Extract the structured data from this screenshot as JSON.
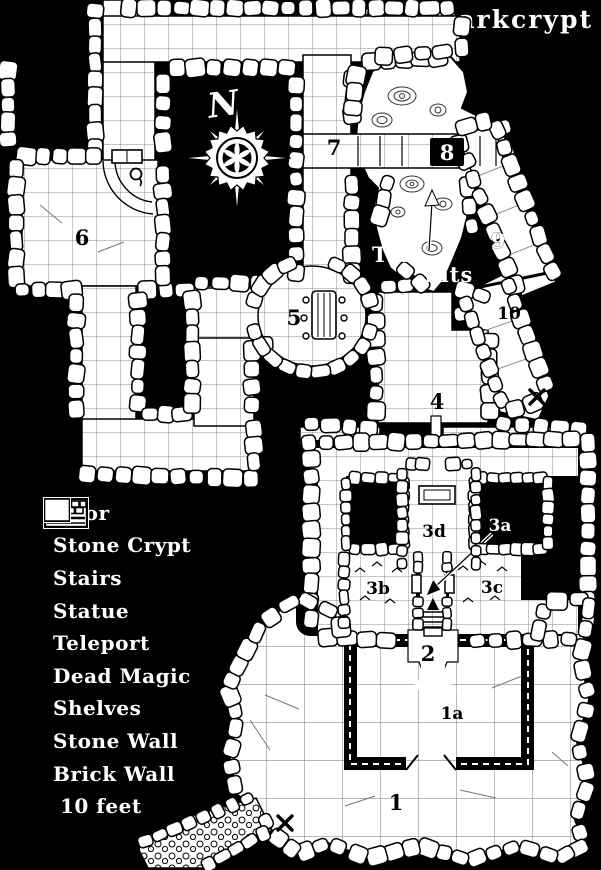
{
  "title": "The Darkcrypt",
  "compass": {
    "label": "N"
  },
  "colors": {
    "background": "#000000",
    "parchment": "#ffffff",
    "ink": "#000000",
    "grid_line": "#8f8f87",
    "label_text": "#ffffff"
  },
  "map": {
    "tar_pits": {
      "line1": "Tar",
      "line2": "Pits"
    },
    "room_labels": [
      {
        "id": "1",
        "x": 396,
        "y": 810,
        "light": false,
        "plate": false
      },
      {
        "id": "1a",
        "x": 452,
        "y": 719,
        "light": false,
        "plate": false
      },
      {
        "id": "2",
        "x": 428,
        "y": 661,
        "light": false,
        "plate": false
      },
      {
        "id": "3a",
        "x": 500,
        "y": 531,
        "light": true,
        "plate": false
      },
      {
        "id": "3b",
        "x": 378,
        "y": 594,
        "light": false,
        "plate": false
      },
      {
        "id": "3c",
        "x": 492,
        "y": 593,
        "light": false,
        "plate": false
      },
      {
        "id": "3d",
        "x": 434,
        "y": 537,
        "light": false,
        "plate": false
      },
      {
        "id": "4",
        "x": 437,
        "y": 409,
        "light": false,
        "plate": false
      },
      {
        "id": "5",
        "x": 294,
        "y": 325,
        "light": false,
        "plate": false
      },
      {
        "id": "6",
        "x": 82,
        "y": 245,
        "light": false,
        "plate": false
      },
      {
        "id": "7",
        "x": 334,
        "y": 155,
        "light": false,
        "plate": false
      },
      {
        "id": "8",
        "x": 447,
        "y": 160,
        "light": true,
        "plate": true
      },
      {
        "id": "9",
        "x": 498,
        "y": 248,
        "light": true,
        "plate": false
      },
      {
        "id": "10",
        "x": 509,
        "y": 319,
        "light": false,
        "plate": false
      }
    ],
    "markers": [
      {
        "type": "teleport",
        "x": 537,
        "y": 397
      },
      {
        "type": "teleport",
        "x": 285,
        "y": 823
      }
    ]
  },
  "legend": {
    "items": [
      {
        "label": "Door",
        "icon": "door-icon"
      },
      {
        "label": "Stone Crypt",
        "icon": "stone-crypt-icon"
      },
      {
        "label": "Stairs",
        "icon": "stairs-icon"
      },
      {
        "label": "Statue",
        "icon": "statue-icon"
      },
      {
        "label": "Teleport",
        "icon": "teleport-icon"
      },
      {
        "label": "Dead Magic",
        "icon": "dead-magic-icon"
      },
      {
        "label": "Shelves",
        "icon": "shelves-icon"
      },
      {
        "label": "Stone Wall",
        "icon": "stone-wall-icon"
      },
      {
        "label": "Brick Wall",
        "icon": "brick-wall-icon"
      },
      {
        "label": "10 feet",
        "icon": "scale-icon"
      }
    ]
  }
}
